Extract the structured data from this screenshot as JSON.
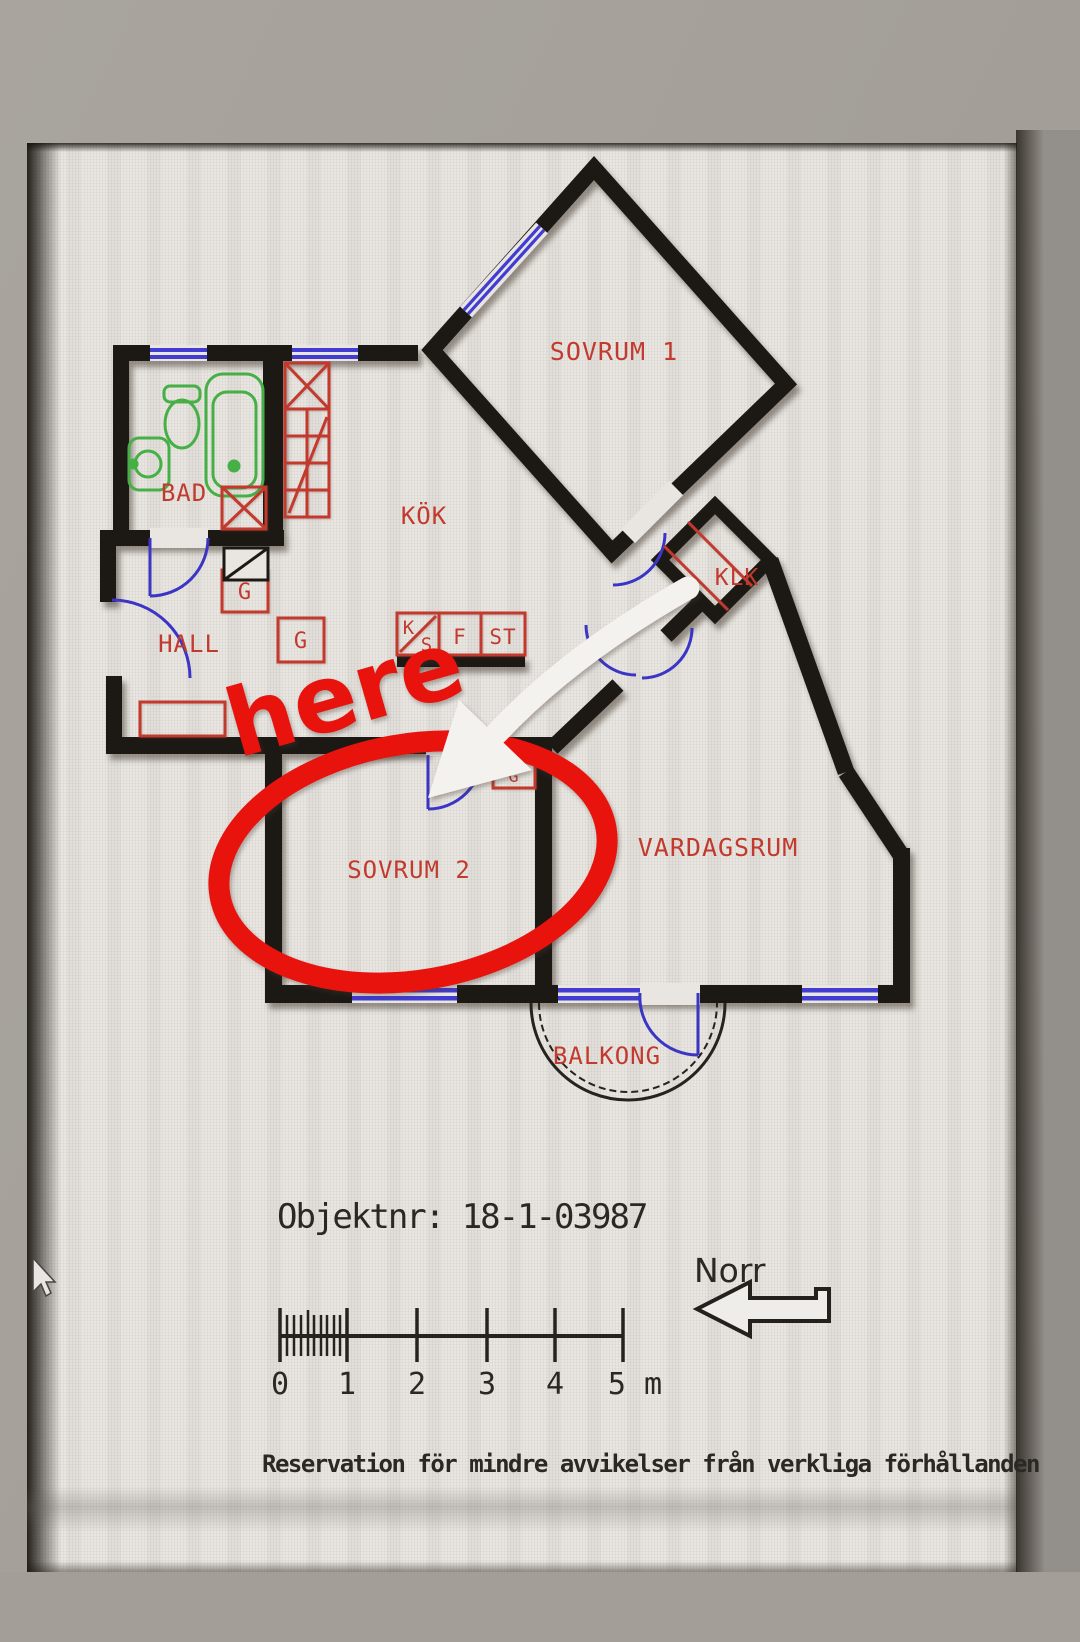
{
  "annotation": {
    "here_label": "here"
  },
  "floor_plan": {
    "rooms": {
      "sovrum1": "SOVRUM 1",
      "kok": "KÖK",
      "bad": "BAD",
      "hall": "HALL",
      "klk": "KLK",
      "sovrum2": "SOVRUM 2",
      "vardagsrum": "VARDAGSRUM",
      "balkong": "BALKONG"
    },
    "closets": {
      "g1": "G",
      "g2": "G",
      "g3": "G"
    },
    "appliances": {
      "k": "K",
      "s": "S",
      "f": "F",
      "st": "ST"
    }
  },
  "footer": {
    "object_number": "Objektnr: 18-1-03987",
    "north_label": "Norr",
    "scale_ticks": [
      "0",
      "1",
      "2",
      "3",
      "4",
      "5 m"
    ],
    "disclaimer": "Reservation för mindre avvikelser från verkliga förhållanden"
  },
  "colors": {
    "wall_black": "#1c1915",
    "plan_red": "#c23a2e",
    "window_blue": "#413cd2",
    "fixture_green": "#46b046",
    "annotation_red": "#e8130d",
    "page_white": "#e9e6e1",
    "surround_grey": "#a5a09a"
  }
}
